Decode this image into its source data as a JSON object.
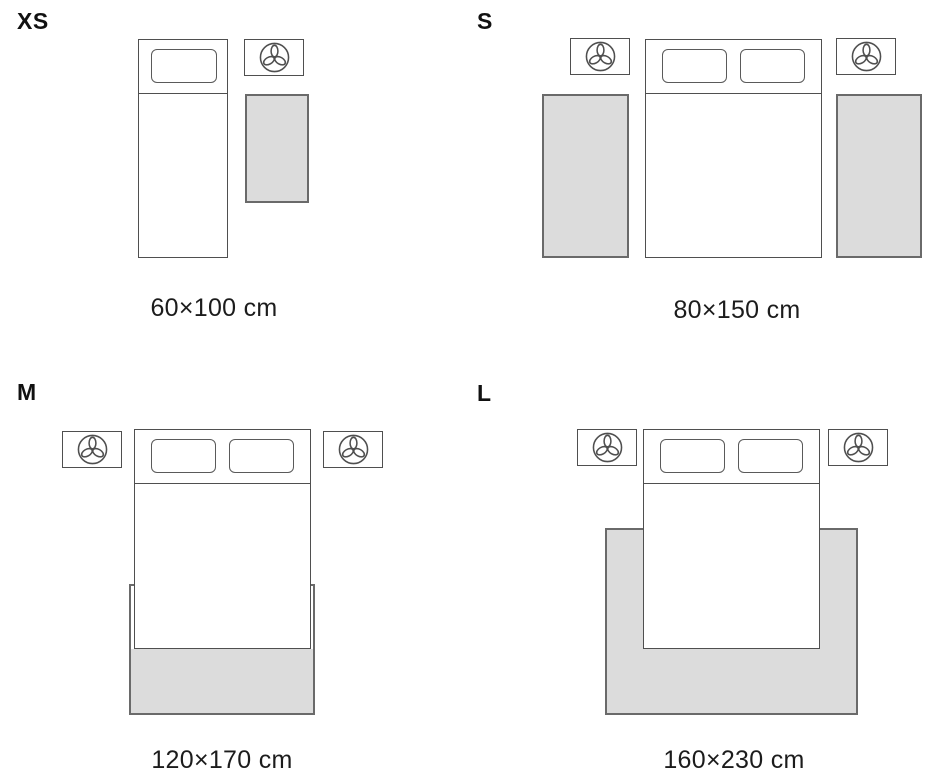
{
  "colors": {
    "background": "#ffffff",
    "rug_fill": "#dcdcdc",
    "outline": "#4f4f4f",
    "rug_outline": "#6a6a6a",
    "text": "#1c1c1c"
  },
  "icons": {
    "nightstand_icon": "plant-icon"
  },
  "panels": [
    {
      "id": "xs",
      "size_label": "XS",
      "dimensions": "60×100 cm",
      "bed_type": "single bed",
      "nightstands": 1,
      "rugs": 1,
      "rug_placement": "beside bed"
    },
    {
      "id": "s",
      "size_label": "S",
      "dimensions": "80×150 cm",
      "bed_type": "double bed",
      "nightstands": 2,
      "rugs": 2,
      "rug_placement": "runner on each side of bed"
    },
    {
      "id": "m",
      "size_label": "M",
      "dimensions": "120×170 cm",
      "bed_type": "double bed",
      "nightstands": 2,
      "rugs": 1,
      "rug_placement": "under foot of bed"
    },
    {
      "id": "l",
      "size_label": "L",
      "dimensions": "160×230 cm",
      "bed_type": "double bed",
      "nightstands": 2,
      "rugs": 1,
      "rug_placement": "under bed, extending at sides and foot"
    }
  ]
}
